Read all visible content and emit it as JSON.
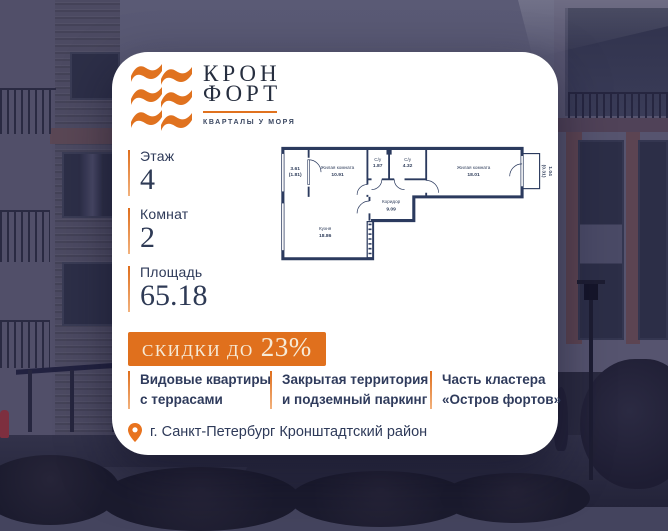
{
  "brand": {
    "line1": "КРОН",
    "line2": "ФОРТ",
    "tagline": "КВАРТАЛЫ У МОРЯ"
  },
  "stats": [
    {
      "label": "Этаж",
      "value": "4"
    },
    {
      "label": "Комнат",
      "value": "2"
    },
    {
      "label": "Площадь",
      "value": "65.18"
    }
  ],
  "floor_plan": {
    "balcony_left": {
      "line1": "3.61",
      "line2": "(1.81)"
    },
    "living_room_1": {
      "name": "Жилая комната",
      "area": "10.91"
    },
    "bathroom_1": {
      "name": "С/у",
      "area": "1.87"
    },
    "bathroom_2": {
      "name": "С/у",
      "area": "4.32"
    },
    "living_room_2": {
      "name": "Жилая комната",
      "area": "18.01"
    },
    "corridor": {
      "name": "Коридор",
      "area": "9.09"
    },
    "kitchen": {
      "name": "Кухня",
      "area": "18.86"
    },
    "balcony_right": {
      "line1": "1.04",
      "line2": "(0.31)"
    }
  },
  "discount": {
    "prefix": "СКИДКИ ДО",
    "value": "23%"
  },
  "features": [
    {
      "line1": "Видовые квартиры",
      "line2": "с террасами"
    },
    {
      "line1": "Закрытая территория",
      "line2": "и подземный паркинг"
    },
    {
      "line1": "Часть кластера",
      "line2": "«Остров фортов»"
    }
  ],
  "location": {
    "text": "г. Санкт-Петербург Кронштадтский район"
  },
  "icons": {
    "logo_mark": "brand-waves-icon",
    "location": "location-pin-icon"
  },
  "colors": {
    "accent_orange": "#e0721f",
    "navy_text": "#2e3a59",
    "banner_bg": "#e0701d",
    "banner_text": "#f6ead6",
    "plan_walls": "#2b3a5e",
    "card_bg": "#ffffff",
    "photo_overlay": "#44445e"
  }
}
